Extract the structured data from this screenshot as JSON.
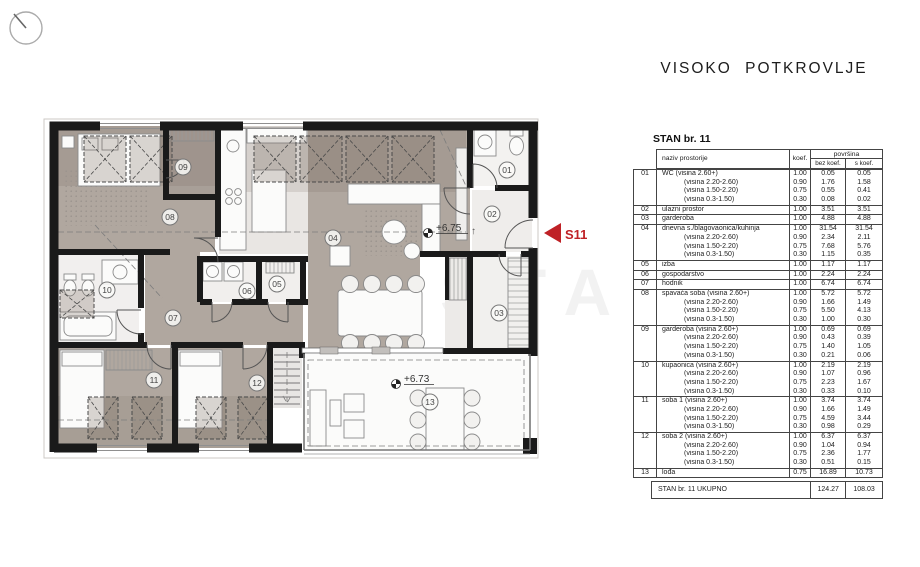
{
  "sheet": {
    "title": "VISOKO POTKROVLJE"
  },
  "plan": {
    "rooms": [
      "01",
      "02",
      "03",
      "04",
      "05",
      "06",
      "07",
      "08",
      "09",
      "10",
      "11",
      "12",
      "13"
    ],
    "level_upper": "+6.75",
    "level_lower": "+6.73",
    "entry_arrow": "↑",
    "unit_label": "S11",
    "watermark": "STA"
  },
  "table": {
    "heading": "STAN br. 11",
    "columns": {
      "name": "naziv prostorije",
      "koef": "koef.",
      "area": "površina",
      "bez": "bez koef.",
      "s": "s koef."
    },
    "rows": [
      {
        "num": "01",
        "lines": [
          [
            "WC (visina 2.60+)",
            "1.00",
            "0.05",
            "0.05"
          ],
          [
            "(visina 2.20-2.60)",
            "0.90",
            "1.76",
            "1.58"
          ],
          [
            "(visina 1.50-2.20)",
            "0.75",
            "0.55",
            "0.41"
          ],
          [
            "(visina 0.3-1.50)",
            "0.30",
            "0.08",
            "0.02"
          ]
        ]
      },
      {
        "num": "02",
        "lines": [
          [
            "ulazni prostor",
            "1.00",
            "3.51",
            "3.51"
          ]
        ]
      },
      {
        "num": "03",
        "lines": [
          [
            "garderoba",
            "1.00",
            "4.88",
            "4.88"
          ]
        ]
      },
      {
        "num": "04",
        "lines": [
          [
            "dnevna s./blagovaonica/kuhinja",
            "1.00",
            "31.54",
            "31.54"
          ],
          [
            "(visina 2.20-2.60)",
            "0.90",
            "2.34",
            "2.11"
          ],
          [
            "(visina 1.50-2.20)",
            "0.75",
            "7.68",
            "5.76"
          ],
          [
            "(visina 0.3-1.50)",
            "0.30",
            "1.15",
            "0.35"
          ]
        ]
      },
      {
        "num": "05",
        "lines": [
          [
            "izba",
            "1.00",
            "1.17",
            "1.17"
          ]
        ]
      },
      {
        "num": "06",
        "lines": [
          [
            "gospodarstvo",
            "1.00",
            "2.24",
            "2.24"
          ]
        ]
      },
      {
        "num": "07",
        "lines": [
          [
            "hodnik",
            "1.00",
            "6.74",
            "6.74"
          ]
        ]
      },
      {
        "num": "08",
        "lines": [
          [
            "spavaća soba (visina 2.60+)",
            "1.00",
            "5.72",
            "5.72"
          ],
          [
            "(visina 2.20-2.60)",
            "0.90",
            "1.66",
            "1.49"
          ],
          [
            "(visina 1.50-2.20)",
            "0.75",
            "5.50",
            "4.13"
          ],
          [
            "(visina 0.3-1.50)",
            "0.30",
            "1.00",
            "0.30"
          ]
        ]
      },
      {
        "num": "09",
        "lines": [
          [
            "garderoba (visina 2.60+)",
            "1.00",
            "0.69",
            "0.69"
          ],
          [
            "(visina 2.20-2.60)",
            "0.90",
            "0.43",
            "0.39"
          ],
          [
            "(visina 1.50-2.20)",
            "0.75",
            "1.40",
            "1.05"
          ],
          [
            "(visina 0.3-1.50)",
            "0.30",
            "0.21",
            "0.06"
          ]
        ]
      },
      {
        "num": "10",
        "lines": [
          [
            "kupaonica (visina 2.60+)",
            "1.00",
            "2.19",
            "2.19"
          ],
          [
            "(visina 2.20-2.60)",
            "0.90",
            "1.07",
            "0.96"
          ],
          [
            "(visina 1.50-2.20)",
            "0.75",
            "2.23",
            "1.67"
          ],
          [
            "(visina 0.3-1.50)",
            "0.30",
            "0.33",
            "0.10"
          ]
        ]
      },
      {
        "num": "11",
        "lines": [
          [
            "soba 1 (visina 2.60+)",
            "1.00",
            "3.74",
            "3.74"
          ],
          [
            "(visina 2.20-2.60)",
            "0.90",
            "1.66",
            "1.49"
          ],
          [
            "(visina 1.50-2.20)",
            "0.75",
            "4.59",
            "3.44"
          ],
          [
            "(visina 0.3-1.50)",
            "0.30",
            "0.98",
            "0.29"
          ]
        ]
      },
      {
        "num": "12",
        "lines": [
          [
            "soba 2 (visina 2.60+)",
            "1.00",
            "6.37",
            "6.37"
          ],
          [
            "(visina 2.20-2.60)",
            "0.90",
            "1.04",
            "0.94"
          ],
          [
            "(visina 1.50-2.20)",
            "0.75",
            "2.36",
            "1.77"
          ],
          [
            "(visina 0.3-1.50)",
            "0.30",
            "0.51",
            "0.15"
          ]
        ]
      },
      {
        "num": "13",
        "lines": [
          [
            "lođa",
            "0.75",
            "16.89",
            "10.73"
          ]
        ]
      }
    ],
    "total": {
      "label": "STAN br. 11 UKUPNO",
      "bez": "124.27",
      "s": "108.03"
    }
  },
  "colors": {
    "accent": "#bf2126",
    "wall": "#1a1a1a",
    "floor": "#b0a79f"
  }
}
